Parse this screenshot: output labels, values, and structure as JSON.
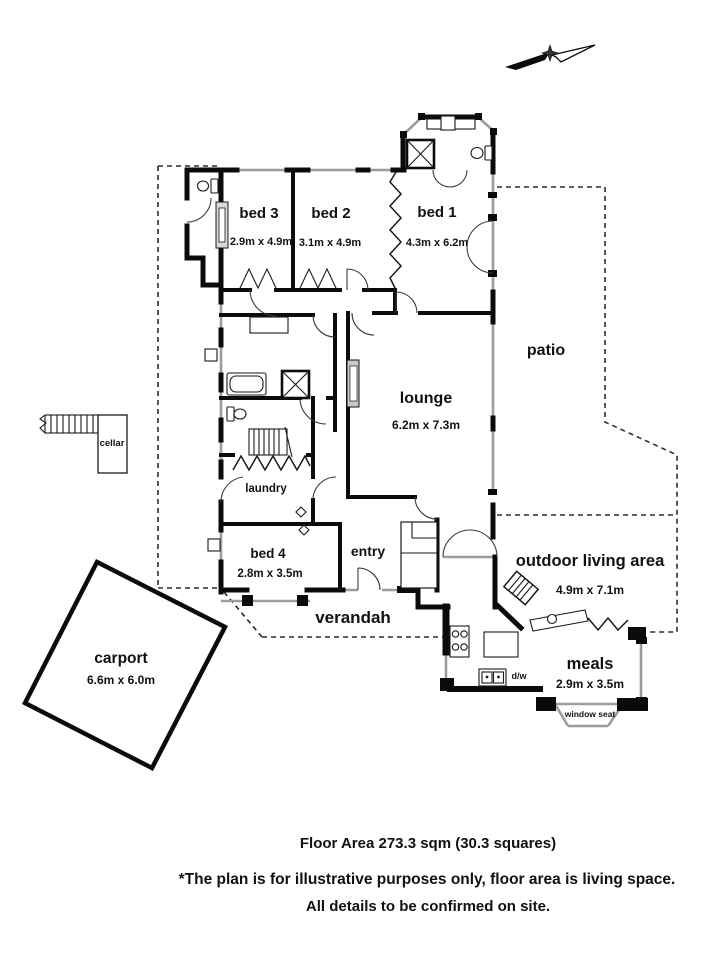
{
  "rooms": {
    "bed3": {
      "name": "bed 3",
      "dims": "2.9m x 4.9m"
    },
    "bed2": {
      "name": "bed 2",
      "dims": "3.1m x 4.9m"
    },
    "bed1": {
      "name": "bed 1",
      "dims": "4.3m x 6.2m"
    },
    "lounge": {
      "name": "lounge",
      "dims": "6.2m x 7.3m"
    },
    "patio": {
      "name": "patio"
    },
    "cellar": {
      "name": "cellar"
    },
    "laundry": {
      "name": "laundry"
    },
    "bed4": {
      "name": "bed 4",
      "dims": "2.8m x 3.5m"
    },
    "entry": {
      "name": "entry"
    },
    "verandah": {
      "name": "verandah"
    },
    "outdoor_living": {
      "name": "outdoor living area",
      "dims": "4.9m x 7.1m"
    },
    "meals": {
      "name": "meals",
      "dims": "2.9m x 3.5m"
    },
    "carport": {
      "name": "carport",
      "dims": "6.6m x 6.0m"
    }
  },
  "features": {
    "window_seat": "window seat",
    "dishwasher": "d/w"
  },
  "footer": {
    "floor_area": "Floor Area 273.3 sqm (30.3 squares)",
    "disclaimer_line1": "*The plan is for illustrative purposes only, floor area is living space.",
    "disclaimer_line2": "All details to be confirmed on site."
  },
  "colors": {
    "wall": "#0b0b0b",
    "window": "#9c9c9c",
    "dashed": "#2b2b2b",
    "text": "#111111",
    "background": "#ffffff"
  }
}
